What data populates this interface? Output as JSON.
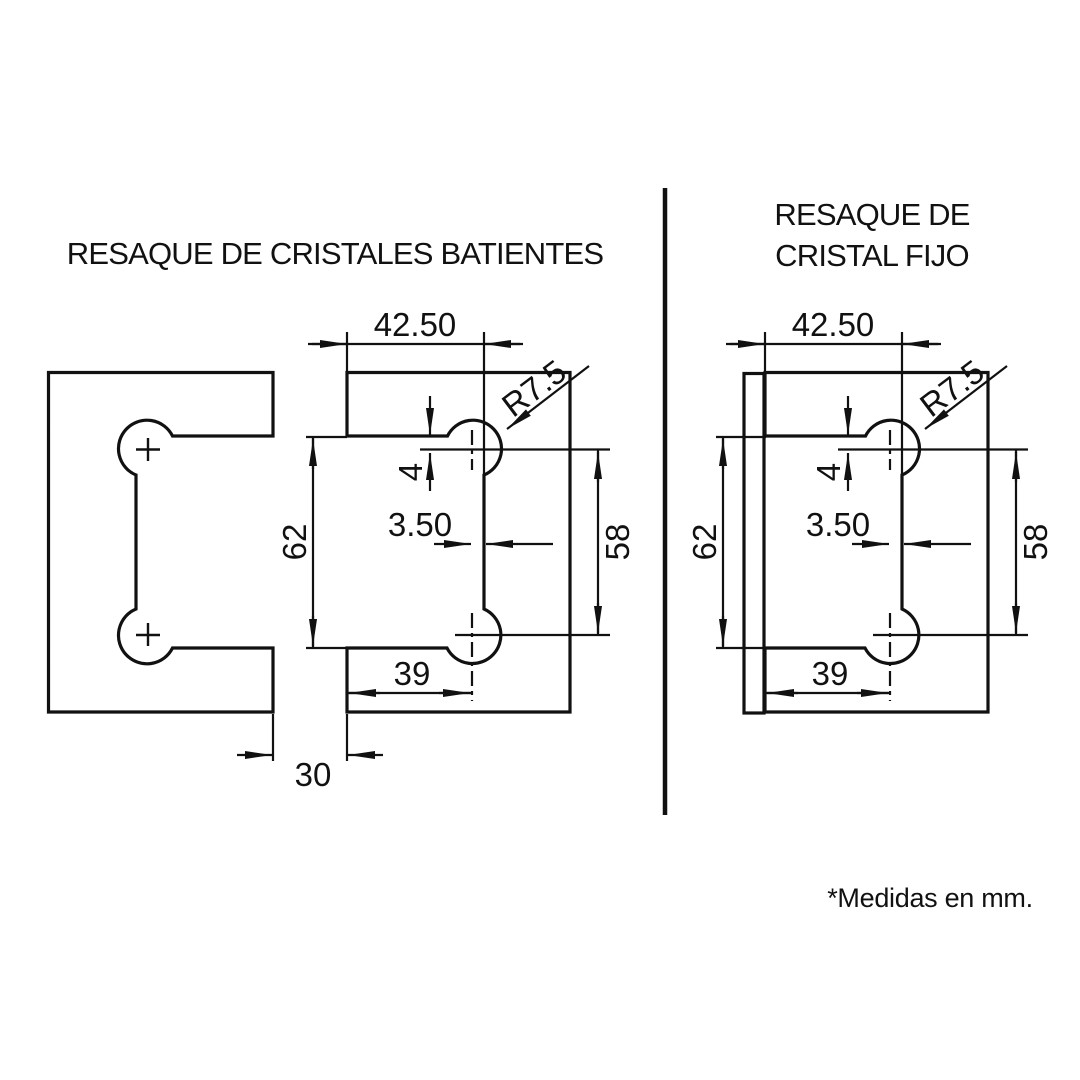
{
  "footnote": "*Medidas en mm.",
  "colors": {
    "glass": "#d8e9f7",
    "wall": "#e8e8e8",
    "line": "#111111",
    "footnote": "#a6acb4"
  },
  "left_diagram": {
    "title": "RESAQUE DE CRISTALES BATIENTES",
    "dims": {
      "top_width": "42.50",
      "radius": "R7.5",
      "hole_offset_top": "4",
      "hole_offset_side": "3.50",
      "notch_height": "62",
      "hole_spacing": "58",
      "bottom_width": "39",
      "glass_gap": "30"
    }
  },
  "right_diagram": {
    "title_line1": "RESAQUE DE",
    "title_line2": "CRISTAL FIJO",
    "dims": {
      "top_width": "42.50",
      "radius": "R7.5",
      "hole_offset_top": "4",
      "hole_offset_side": "3.50",
      "notch_height": "62",
      "hole_spacing": "58",
      "bottom_width": "39"
    }
  }
}
